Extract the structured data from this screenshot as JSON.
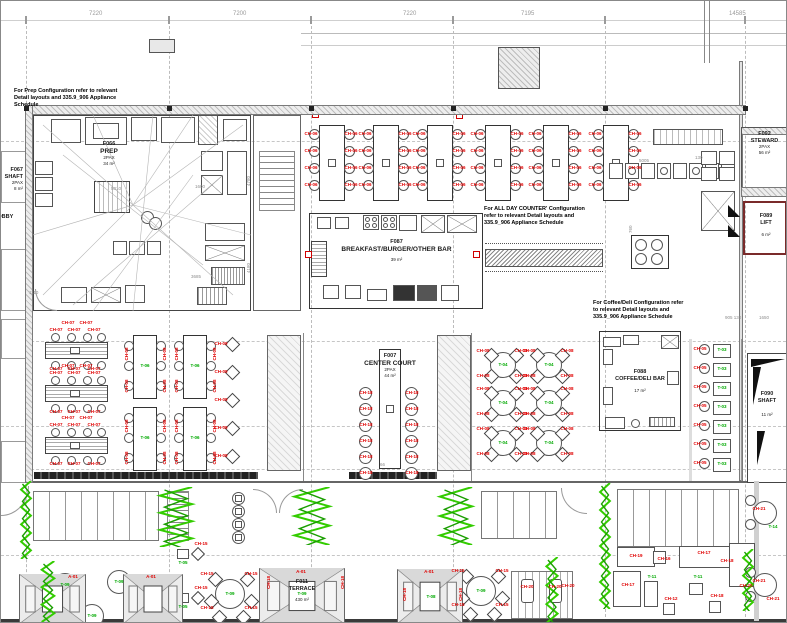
{
  "dimensions": {
    "top": [
      "7220",
      "7200",
      "7220",
      "7195",
      "14585"
    ],
    "annotations": [
      "5010",
      "1600",
      "4780",
      "4180",
      "3685",
      "1110",
      "5005",
      "130",
      "760",
      "905 130",
      "1650",
      "66"
    ]
  },
  "notes": {
    "prep": "For Prep Configuration refer to relevant Detail layouts and 335.9_906 Appliance Schedule",
    "all_day_counter": "For ALL DAY COUNTER' Configuration refer to relevant Detail layouts and 335.9_906 Appliance Schedule",
    "coffee_deli": "For Coffee/Deli Configuration refer to relevant Detail layouts and 335.9_906 Appliance Schedule"
  },
  "rooms": {
    "prep": {
      "id": "F066",
      "name": "PREP",
      "pax": "2PAX",
      "area": "34 m²"
    },
    "shaft_left": {
      "id": "F067",
      "name": "SHAFT",
      "pax": "2PAX",
      "area": "8 m²"
    },
    "lobby": {
      "name": "LOBBY"
    },
    "breakfast_bar": {
      "id": "F087",
      "name": "BREAKFAST/BURGER/OTHER BAR",
      "area": "39 m²"
    },
    "center_court": {
      "id": "F007",
      "name": "CENTER COURT",
      "pax": "2PAX",
      "area": "44 m²"
    },
    "coffee_deli": {
      "id": "F088",
      "name": "COFFEE/DELI BAR",
      "area": "17 m²"
    },
    "steward": {
      "id": "F092",
      "name": "STEWARD",
      "pax": "2PAX",
      "area": "56 m²"
    },
    "lift": {
      "id": "F089",
      "name": "LIFT",
      "area": "6 m²"
    },
    "shaft_right": {
      "id": "F090",
      "name": "SHAFT",
      "area": "11 m²"
    },
    "terrace": {
      "id": "F011",
      "name": "TERRACE",
      "area": "430 m²"
    }
  },
  "furniture_labels": {
    "chair_counter": "CH-06",
    "chair_long_table": "CH-07",
    "chair_square_table": "CH-08",
    "chair_diamond": "CH-09",
    "chair_center_court": "CH-18",
    "chair_two_top": "CH-05",
    "chair_terrace": "CH-15",
    "chair_lounge_sofa": "CH-19",
    "chair_lounge_side": "CH-16",
    "chair_lounge_long": "CH-17",
    "chair_lounge_corner": "CH-18",
    "chair_lounge_stool": "CH-12",
    "chair_lounger": "CH-20",
    "chair_edge": "CH-21",
    "chair_awning": "CH-18",
    "table_square_pair": "T-06",
    "table_round": "T-04",
    "table_two_top": "T-03",
    "table_terrace_round": "T-09",
    "table_terrace_small": "T-05",
    "table_lounge": "T-11",
    "table_edge": "T-14",
    "table_awning": "T-08",
    "awning": "A-01"
  },
  "colors": {
    "chair_label_red": "#e00000",
    "table_label_green": "#00a900",
    "wall_gray": "#d7d7d7",
    "plant_green": "#33cc00"
  }
}
